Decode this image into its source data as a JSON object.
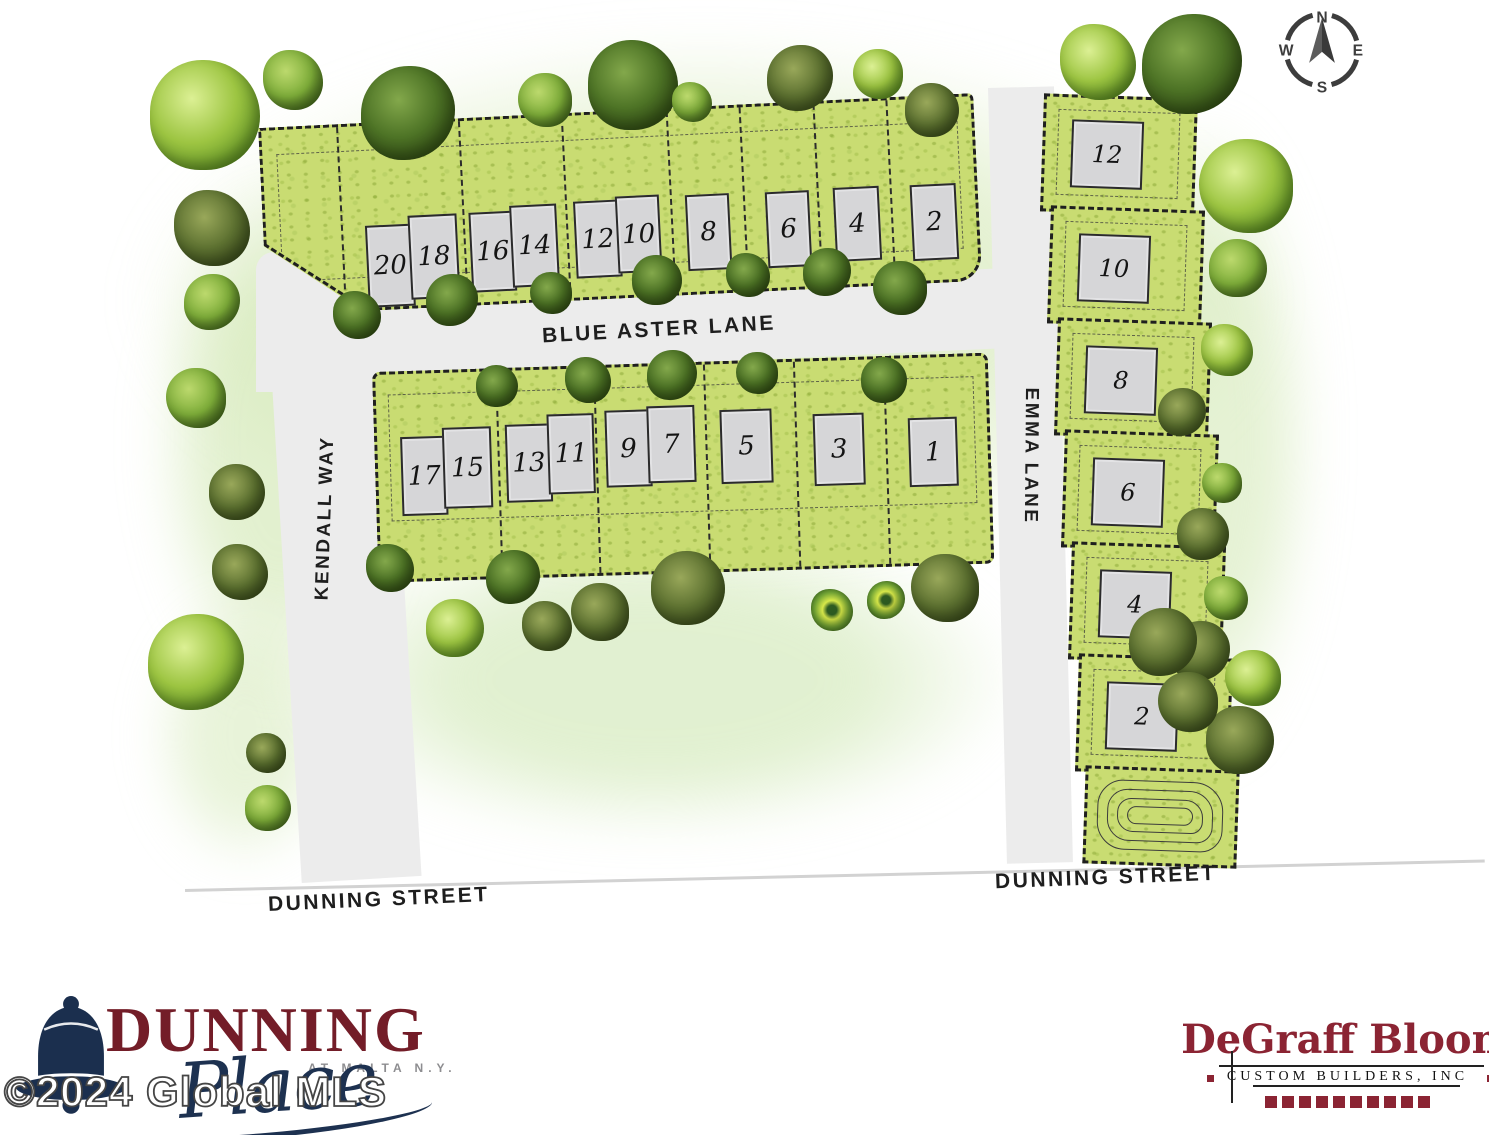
{
  "compass": {
    "n": "N",
    "e": "E",
    "s": "S",
    "w": "W"
  },
  "streets": {
    "blue_aster": "BLUE ASTER LANE",
    "kendall": "KENDALL WAY",
    "emma": "EMMA LANE",
    "dunning_west": "DUNNING STREET",
    "dunning_east": "DUNNING STREET"
  },
  "lots": {
    "north_row": [
      "20",
      "18",
      "16",
      "14",
      "12",
      "10",
      "8",
      "6",
      "4",
      "2"
    ],
    "south_row": [
      "17",
      "15",
      "13",
      "11",
      "9",
      "7",
      "5",
      "3",
      "1"
    ],
    "east_column": [
      "12",
      "10",
      "8",
      "6",
      "4",
      "2"
    ]
  },
  "branding": {
    "community": {
      "name": "DUNNING",
      "tagline": "AT MALTA N.Y.",
      "script": "Place"
    },
    "builder": {
      "name_left": "DeGraff",
      "name_right": "Bloom",
      "subtitle": "CUSTOM BUILDERS, INC"
    }
  },
  "watermark": "©2024 Global MLS",
  "colors": {
    "lot_green": "#c9dc72",
    "road_gray": "#ececec",
    "brand_maroon": "#8b2433",
    "brand_navy": "#1d3150",
    "dunning_red": "#731d28"
  }
}
